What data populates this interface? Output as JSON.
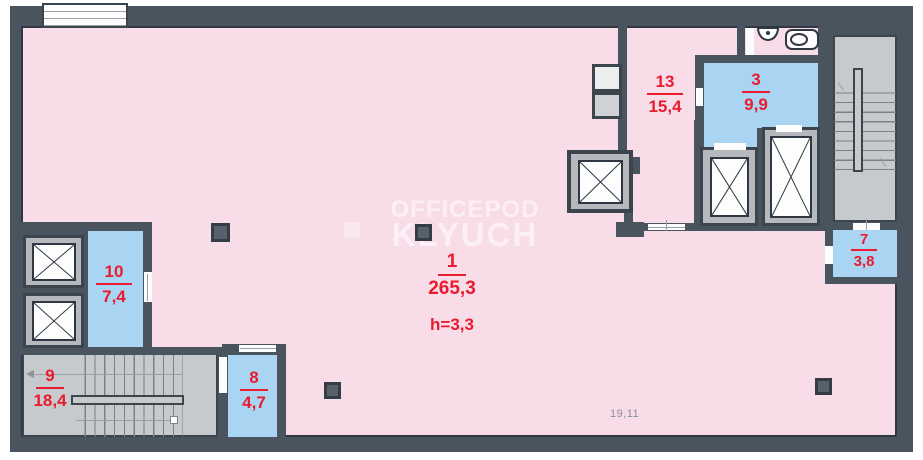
{
  "plan": {
    "watermark": {
      "line1": "OFFICEPOD",
      "line2": "KLYUCH"
    },
    "rooms": [
      {
        "number": "1",
        "area": "265,3",
        "height": "h=3,3"
      },
      {
        "number": "13",
        "area": "15,4"
      },
      {
        "number": "3",
        "area": "9,9"
      },
      {
        "number": "7",
        "area": "3,8"
      },
      {
        "number": "10",
        "area": "7,4"
      },
      {
        "number": "9",
        "area": "18,4"
      },
      {
        "number": "8",
        "area": "4,7"
      }
    ],
    "annotations": {
      "bottom_dimension": "19,11"
    },
    "colors": {
      "wall": "#4a545e",
      "floor": "#f8dce8",
      "highlight_room": "#aad5f2",
      "stairwell": "#c7cacc",
      "label_red": "#e81c2e",
      "watermark": "rgba(255,255,255,0.55)"
    },
    "icons": [
      "elevator-icon",
      "stairs-icon",
      "sink-icon",
      "toilet-icon",
      "column-icon",
      "window-icon",
      "door-icon"
    ]
  }
}
